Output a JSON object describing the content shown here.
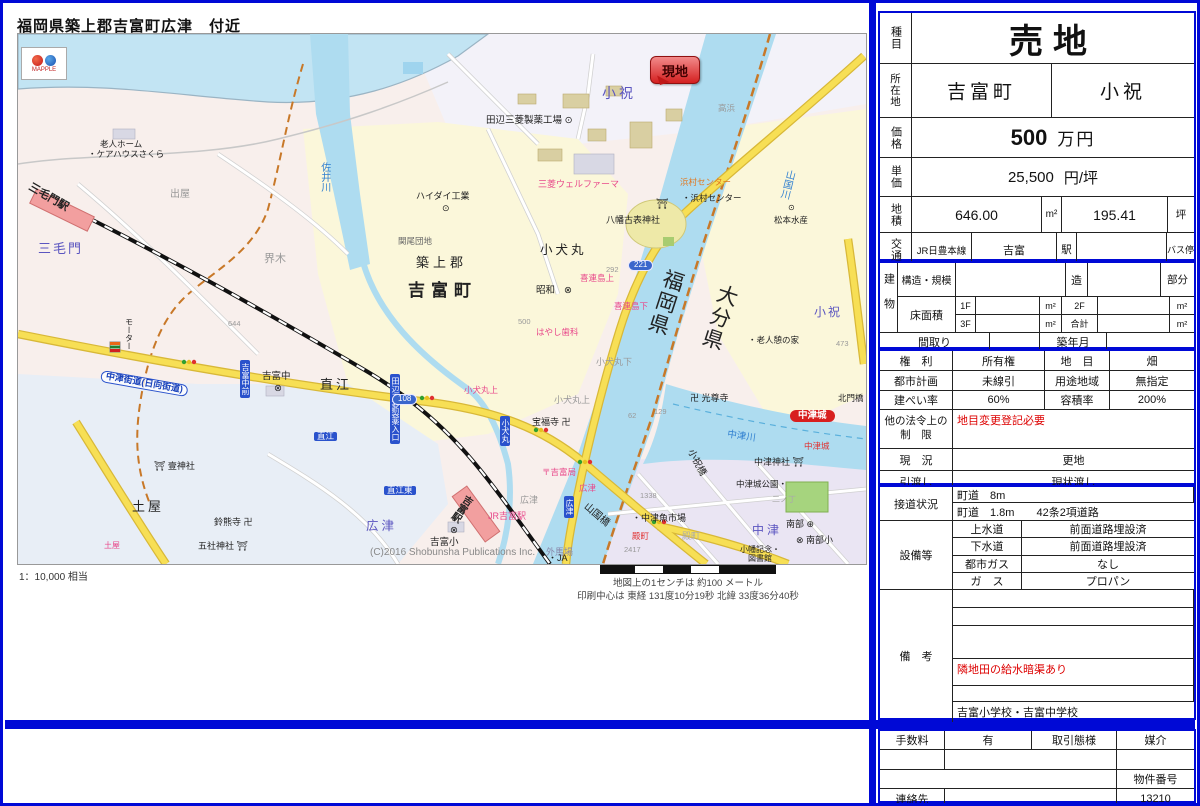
{
  "map": {
    "title": "福岡県築上郡吉富町広津　付近",
    "logo_text": "MAPPLE",
    "marker_label": "現地",
    "scale_note": "1：10,000 相当",
    "scale_caption": "地図上の1センチは 約100 メートル",
    "print_center": "印刷中心は 東経 131度10分19秒  北緯 33度36分40秒",
    "copyright": "(C)2016 Shobunsha Publications Inc.",
    "labels": [
      {
        "t": "小祝",
        "x": 584,
        "y": 52,
        "c": "#5b55c0",
        "s": 14,
        "sp": 3
      },
      {
        "t": "高浜",
        "x": 700,
        "y": 70,
        "c": "#999",
        "s": 8.5
      },
      {
        "t": "田辺三菱製薬工場 ⊙",
        "x": 468,
        "y": 82,
        "s": 9.5
      },
      {
        "t": "老人ホーム",
        "x": 82,
        "y": 106,
        "s": 8.5
      },
      {
        "t": "・ケアハウスさくら",
        "x": 70,
        "y": 116,
        "s": 8.5
      },
      {
        "t": "三毛門駅",
        "x": 14,
        "y": 148,
        "s": 11,
        "b": 1,
        "r": 30
      },
      {
        "t": "三毛門",
        "x": 20,
        "y": 208,
        "c": "#5b55c0",
        "s": 13,
        "sp": 2
      },
      {
        "t": "出屋",
        "x": 152,
        "y": 156,
        "c": "#999",
        "s": 10
      },
      {
        "t": "界木",
        "x": 246,
        "y": 220,
        "c": "#999",
        "s": 11
      },
      {
        "t": "佐井川",
        "x": 300,
        "y": 128,
        "c": "#2f7fd0",
        "s": 10,
        "v": 1
      },
      {
        "t": "ハイダイ工業",
        "x": 398,
        "y": 158,
        "s": 9
      },
      {
        "t": "⊙",
        "x": 424,
        "y": 170,
        "s": 9
      },
      {
        "t": "関尾団地",
        "x": 380,
        "y": 203,
        "c": "#666",
        "s": 8.5
      },
      {
        "t": "築上郡",
        "x": 398,
        "y": 222,
        "s": 13,
        "sp": 4
      },
      {
        "t": "吉富町",
        "x": 390,
        "y": 248,
        "s": 17,
        "b": 1,
        "sp": 6
      },
      {
        "t": "三菱ウェルファーマ",
        "x": 520,
        "y": 146,
        "c": "#e8488a",
        "s": 9
      },
      {
        "t": "⛩",
        "x": 638,
        "y": 166,
        "s": 10
      },
      {
        "t": "八幡古表神社",
        "x": 588,
        "y": 182,
        "s": 9
      },
      {
        "t": "浜村センター",
        "x": 662,
        "y": 144,
        "c": "#e07820",
        "s": 8.5
      },
      {
        "t": "・浜村センター",
        "x": 664,
        "y": 160,
        "s": 8.5
      },
      {
        "t": "221",
        "x": 610,
        "y": 226,
        "type": "shield"
      },
      {
        "t": "福岡県",
        "x": 646,
        "y": 232,
        "s": 21,
        "v": 1,
        "r": 18,
        "sp": 2
      },
      {
        "t": "大分県",
        "x": 700,
        "y": 247,
        "s": 21,
        "v": 1,
        "r": 18,
        "sp": 2
      },
      {
        "t": "山国川",
        "x": 766,
        "y": 134,
        "c": "#2f7fd0",
        "s": 10,
        "v": 1,
        "r": 14
      },
      {
        "t": "⊙",
        "x": 770,
        "y": 170,
        "s": 8
      },
      {
        "t": "松本水産",
        "x": 756,
        "y": 182,
        "s": 8.5
      },
      {
        "t": "小祝",
        "x": 796,
        "y": 272,
        "c": "#5b55c0",
        "s": 12,
        "sp": 2
      },
      {
        "t": "・老人憩の家",
        "x": 730,
        "y": 302,
        "s": 8.5
      },
      {
        "t": "473",
        "x": 818,
        "y": 306,
        "c": "#999",
        "s": 7.5
      },
      {
        "t": "卍 光尊寺",
        "x": 672,
        "y": 360,
        "s": 9
      },
      {
        "t": "北門橋",
        "x": 820,
        "y": 360,
        "s": 8.5
      },
      {
        "t": "小犬丸",
        "x": 522,
        "y": 210,
        "s": 12.5,
        "sp": 3
      },
      {
        "t": "292",
        "x": 588,
        "y": 232,
        "c": "#999",
        "s": 7.5
      },
      {
        "t": "喜連島上",
        "x": 562,
        "y": 240,
        "c": "#e8488a",
        "s": 8.5
      },
      {
        "t": "昭和",
        "x": 518,
        "y": 252,
        "s": 9.5
      },
      {
        "t": "⊗",
        "x": 546,
        "y": 252,
        "s": 9.5
      },
      {
        "t": "喜連島下",
        "x": 596,
        "y": 268,
        "c": "#e8488a",
        "s": 8.5
      },
      {
        "t": "500",
        "x": 500,
        "y": 284,
        "c": "#999",
        "s": 7.5
      },
      {
        "t": "はやし歯科",
        "x": 518,
        "y": 294,
        "c": "#e8488a",
        "s": 8.5
      },
      {
        "t": "小犬丸下",
        "x": 578,
        "y": 324,
        "c": "#999",
        "s": 9
      },
      {
        "t": "小犬丸上",
        "x": 536,
        "y": 362,
        "c": "#999",
        "s": 9
      },
      {
        "t": "小犬丸上",
        "x": 446,
        "y": 352,
        "c": "#e8488a",
        "s": 8.5
      },
      {
        "t": "宝福寺 卍",
        "x": 514,
        "y": 384,
        "s": 9
      },
      {
        "t": "644",
        "x": 210,
        "y": 286,
        "c": "#999",
        "s": 7.5
      },
      {
        "t": "モーター",
        "x": 106,
        "y": 284,
        "s": 8,
        "v": 1
      },
      {
        "t": "吉富中前",
        "x": 222,
        "y": 326,
        "type": "vbadge"
      },
      {
        "t": "吉富中",
        "x": 244,
        "y": 338,
        "s": 9.5
      },
      {
        "t": "⊗",
        "x": 256,
        "y": 350,
        "s": 9.5
      },
      {
        "t": "直江",
        "x": 302,
        "y": 344,
        "s": 13,
        "sp": 3
      },
      {
        "t": "直江",
        "x": 296,
        "y": 398,
        "type": "badge"
      },
      {
        "t": "中津街道(日向街道)",
        "x": 84,
        "y": 336,
        "type": "rname",
        "r": 10
      },
      {
        "t": "⛩ 壹神社",
        "x": 136,
        "y": 428,
        "s": 9
      },
      {
        "t": "土屋",
        "x": 114,
        "y": 466,
        "s": 13,
        "sp": 3
      },
      {
        "t": "土屋",
        "x": 86,
        "y": 508,
        "c": "#e8488a",
        "s": 8
      },
      {
        "t": "鈴熊寺 卍",
        "x": 196,
        "y": 484,
        "s": 9
      },
      {
        "t": "五社神社 ⛩",
        "x": 180,
        "y": 508,
        "s": 9
      },
      {
        "t": "田辺三菱製薬入口",
        "x": 372,
        "y": 340,
        "type": "vbadge"
      },
      {
        "t": "108",
        "x": 374,
        "y": 360,
        "type": "shield"
      },
      {
        "t": "小犬丸",
        "x": 482,
        "y": 382,
        "type": "vbadge"
      },
      {
        "t": "直江東",
        "x": 366,
        "y": 452,
        "type": "badge"
      },
      {
        "t": "広津",
        "x": 348,
        "y": 486,
        "c": "#5b55c0",
        "s": 12.5,
        "sp": 3
      },
      {
        "t": "⊗",
        "x": 432,
        "y": 492,
        "s": 9.5
      },
      {
        "t": "吉富小",
        "x": 412,
        "y": 504,
        "s": 9.5
      },
      {
        "t": "JR吉富駅",
        "x": 470,
        "y": 478,
        "c": "#e8488a",
        "s": 9
      },
      {
        "t": "吉富駅",
        "x": 446,
        "y": 458,
        "s": 10,
        "b": 1,
        "v": 1,
        "r": 34
      },
      {
        "t": "広津",
        "x": 502,
        "y": 462,
        "c": "#999",
        "s": 9
      },
      {
        "t": "広津",
        "x": 561,
        "y": 450,
        "c": "#e8488a",
        "s": 8.5
      },
      {
        "t": "広津",
        "x": 546,
        "y": 462,
        "type": "vbadge"
      },
      {
        "t": "〒吉富局",
        "x": 524,
        "y": 434,
        "c": "#e8488a",
        "s": 8.5
      },
      {
        "t": "山国橋",
        "x": 570,
        "y": 468,
        "s": 10,
        "r": 40
      },
      {
        "t": "小祝橋",
        "x": 676,
        "y": 414,
        "s": 9.5,
        "r": 62
      },
      {
        "t": "殿町",
        "x": 614,
        "y": 498,
        "c": "#e03030",
        "s": 8.5
      },
      {
        "t": "外馬場",
        "x": 528,
        "y": 514,
        "c": "#8888aa",
        "s": 9
      },
      {
        "t": "62",
        "x": 610,
        "y": 378,
        "c": "#999",
        "s": 7.5
      },
      {
        "t": "129",
        "x": 636,
        "y": 374,
        "c": "#999",
        "s": 7.5
      },
      {
        "t": "1338",
        "x": 622,
        "y": 458,
        "c": "#999",
        "s": 7.5
      },
      {
        "t": "2417",
        "x": 606,
        "y": 512,
        "c": "#999",
        "s": 7.5
      },
      {
        "t": "中津城",
        "x": 772,
        "y": 376,
        "type": "pill"
      },
      {
        "t": "中津川",
        "x": 710,
        "y": 396,
        "c": "#2f7fd0",
        "s": 9.5,
        "r": 8
      },
      {
        "t": "中津城",
        "x": 786,
        "y": 408,
        "c": "#e03030",
        "s": 8.5
      },
      {
        "t": "中津神社 ⛩",
        "x": 736,
        "y": 424,
        "s": 9
      },
      {
        "t": "中津城公園・",
        "x": 718,
        "y": 446,
        "s": 8.5
      },
      {
        "t": "二ノ丁",
        "x": 754,
        "y": 462,
        "c": "#aaa",
        "s": 8
      },
      {
        "t": "・中津魚市場",
        "x": 614,
        "y": 480,
        "s": 9
      },
      {
        "t": "殿町",
        "x": 664,
        "y": 498,
        "c": "#aaa",
        "s": 9
      },
      {
        "t": "中津",
        "x": 734,
        "y": 490,
        "c": "#5b55c0",
        "s": 12,
        "sp": 3
      },
      {
        "t": "南部 ⊕",
        "x": 768,
        "y": 486,
        "s": 9
      },
      {
        "t": "⊗ 南部小",
        "x": 778,
        "y": 502,
        "s": 9
      },
      {
        "t": "小幡記念・",
        "x": 722,
        "y": 512,
        "s": 8
      },
      {
        "t": "図書館",
        "x": 730,
        "y": 521,
        "s": 8
      },
      {
        "t": "・JA",
        "x": 530,
        "y": 520,
        "s": 9
      },
      {
        "t": "(C)2016 Shobunsha Publications Inc.",
        "x": 352,
        "y": 514,
        "c": "#888",
        "s": 10
      }
    ]
  },
  "listing": {
    "category_label": "種目",
    "category": "売地",
    "location_label": "所在地",
    "location_city": "吉富町",
    "location_area": "小祝",
    "price_label": "価格",
    "price_value": "500",
    "price_unit": "万円",
    "unit_price_label": "単価",
    "unit_price_value": "25,500",
    "unit_price_unit": "円/坪",
    "land_label": "地積",
    "land_m2_value": "646.00",
    "m2_unit": "m²",
    "land_tsubo_value": "195.41",
    "tsubo_unit": "坪",
    "transport_label": "交通",
    "transport_line": "JR日豊本線",
    "transport_station": "吉富",
    "station_suffix": "駅",
    "bus_stop_label": "バス停",
    "building": {
      "label": "建物",
      "structure_label": "構造・規模",
      "zou_label": "造",
      "part_label": "部分",
      "floor_area_label": "床面積",
      "f1_label": "1F",
      "f2_label": "2F",
      "f3_label": "3F",
      "total_label": "合計",
      "madori_label": "間取り",
      "built_label": "築年月"
    },
    "rights_label": "権　利",
    "rights_value": "所有権",
    "landcat_label": "地　目",
    "landcat_value": "畑",
    "cityplan_label": "都市計画",
    "cityplan_value": "未線引",
    "zone_label": "用途地域",
    "zone_value": "無指定",
    "bcr_label": "建ぺい率",
    "bcr_value": "60%",
    "far_label": "容積率",
    "far_value": "200%",
    "other_law_label_1": "他の法令上の",
    "other_law_label_2": "制　限",
    "other_law_value": "地目変更登記必要",
    "status_label": "現　況",
    "status_value": "更地",
    "handover_label": "引渡し",
    "handover_value": "現状渡し",
    "road_label": "接道状況",
    "road_line1": "町道　8m",
    "road_line2": "町道　1.8m　　42条2項道路",
    "facilities_label": "設備等",
    "water_label": "上水道",
    "water_value": "前面道路埋設済",
    "sewer_label": "下水道",
    "sewer_value": "前面道路埋設済",
    "citygas_label": "都市ガス",
    "citygas_value": "なし",
    "gas_label": "ガ　ス",
    "gas_value": "プロパン",
    "remarks_label": "備　考",
    "remarks_red": "隣地田の給水暗渠あり",
    "remarks_schools": "吉富小学校・吉富中学校",
    "fee_label": "手数料",
    "fee_value": "有",
    "deal_type_label": "取引態様",
    "deal_type_value": "媒介",
    "property_no_label": "物件番号",
    "property_no_value": "13210",
    "contact_label": "連絡先"
  }
}
